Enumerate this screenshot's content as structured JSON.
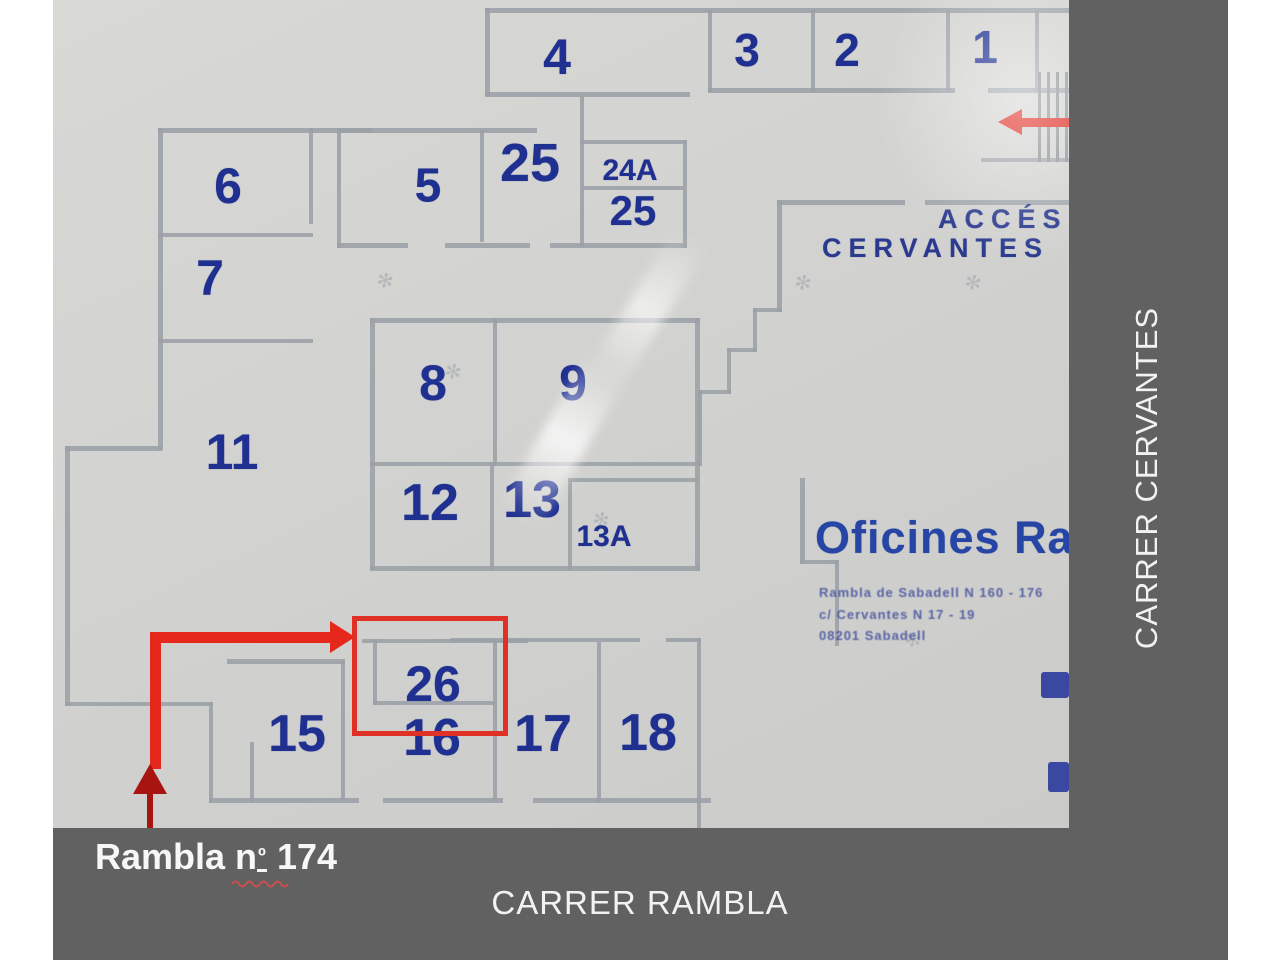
{
  "streets": {
    "right": "CARRER CERVANTES",
    "bottom": "CARRER RAMBLA"
  },
  "caption": {
    "prefix": "Rambla n",
    "ordinal": "º",
    "suffix": " 174"
  },
  "plan": {
    "access": {
      "line1": "ACCÉS",
      "line2": "CERVANTES"
    },
    "title": "Oficines Rambla",
    "address": [
      "Rambla de Sabadell N 160 - 176",
      "c/ Cervantes N 17 - 19",
      "08201 Sabadell"
    ],
    "rooms": [
      {
        "label": "4",
        "x": 504,
        "y": 57,
        "s": 50
      },
      {
        "label": "3",
        "x": 694,
        "y": 50,
        "s": 46
      },
      {
        "label": "2",
        "x": 794,
        "y": 50,
        "s": 46
      },
      {
        "label": "1",
        "x": 932,
        "y": 47,
        "s": 46
      },
      {
        "label": "6",
        "x": 175,
        "y": 186,
        "s": 50
      },
      {
        "label": "5",
        "x": 375,
        "y": 186,
        "s": 48
      },
      {
        "label": "25",
        "x": 477,
        "y": 163,
        "s": 54
      },
      {
        "label": "24A",
        "x": 577,
        "y": 171,
        "s": 30
      },
      {
        "label": "25",
        "x": 580,
        "y": 211,
        "s": 42
      },
      {
        "label": "7",
        "x": 157,
        "y": 278,
        "s": 50
      },
      {
        "label": "8",
        "x": 380,
        "y": 383,
        "s": 50
      },
      {
        "label": "9",
        "x": 520,
        "y": 383,
        "s": 50
      },
      {
        "label": "11",
        "x": 179,
        "y": 452,
        "s": 50
      },
      {
        "label": "12",
        "x": 377,
        "y": 503,
        "s": 52
      },
      {
        "label": "13",
        "x": 479,
        "y": 500,
        "s": 52
      },
      {
        "label": "13A",
        "x": 551,
        "y": 537,
        "s": 30
      },
      {
        "label": "26",
        "x": 380,
        "y": 684,
        "s": 50
      },
      {
        "label": "15",
        "x": 244,
        "y": 734,
        "s": 52
      },
      {
        "label": "16",
        "x": 379,
        "y": 738,
        "s": 52
      },
      {
        "label": "17",
        "x": 490,
        "y": 734,
        "s": 52
      },
      {
        "label": "18",
        "x": 595,
        "y": 733,
        "s": 52
      }
    ]
  },
  "colors": {
    "number_blue": "#1f3090",
    "accent_red": "#e6271b",
    "dark_red": "#a81511",
    "band_gray": "#616161",
    "wall_gray": "#9aa0a6",
    "photo_gray": "#d2d2d0"
  }
}
